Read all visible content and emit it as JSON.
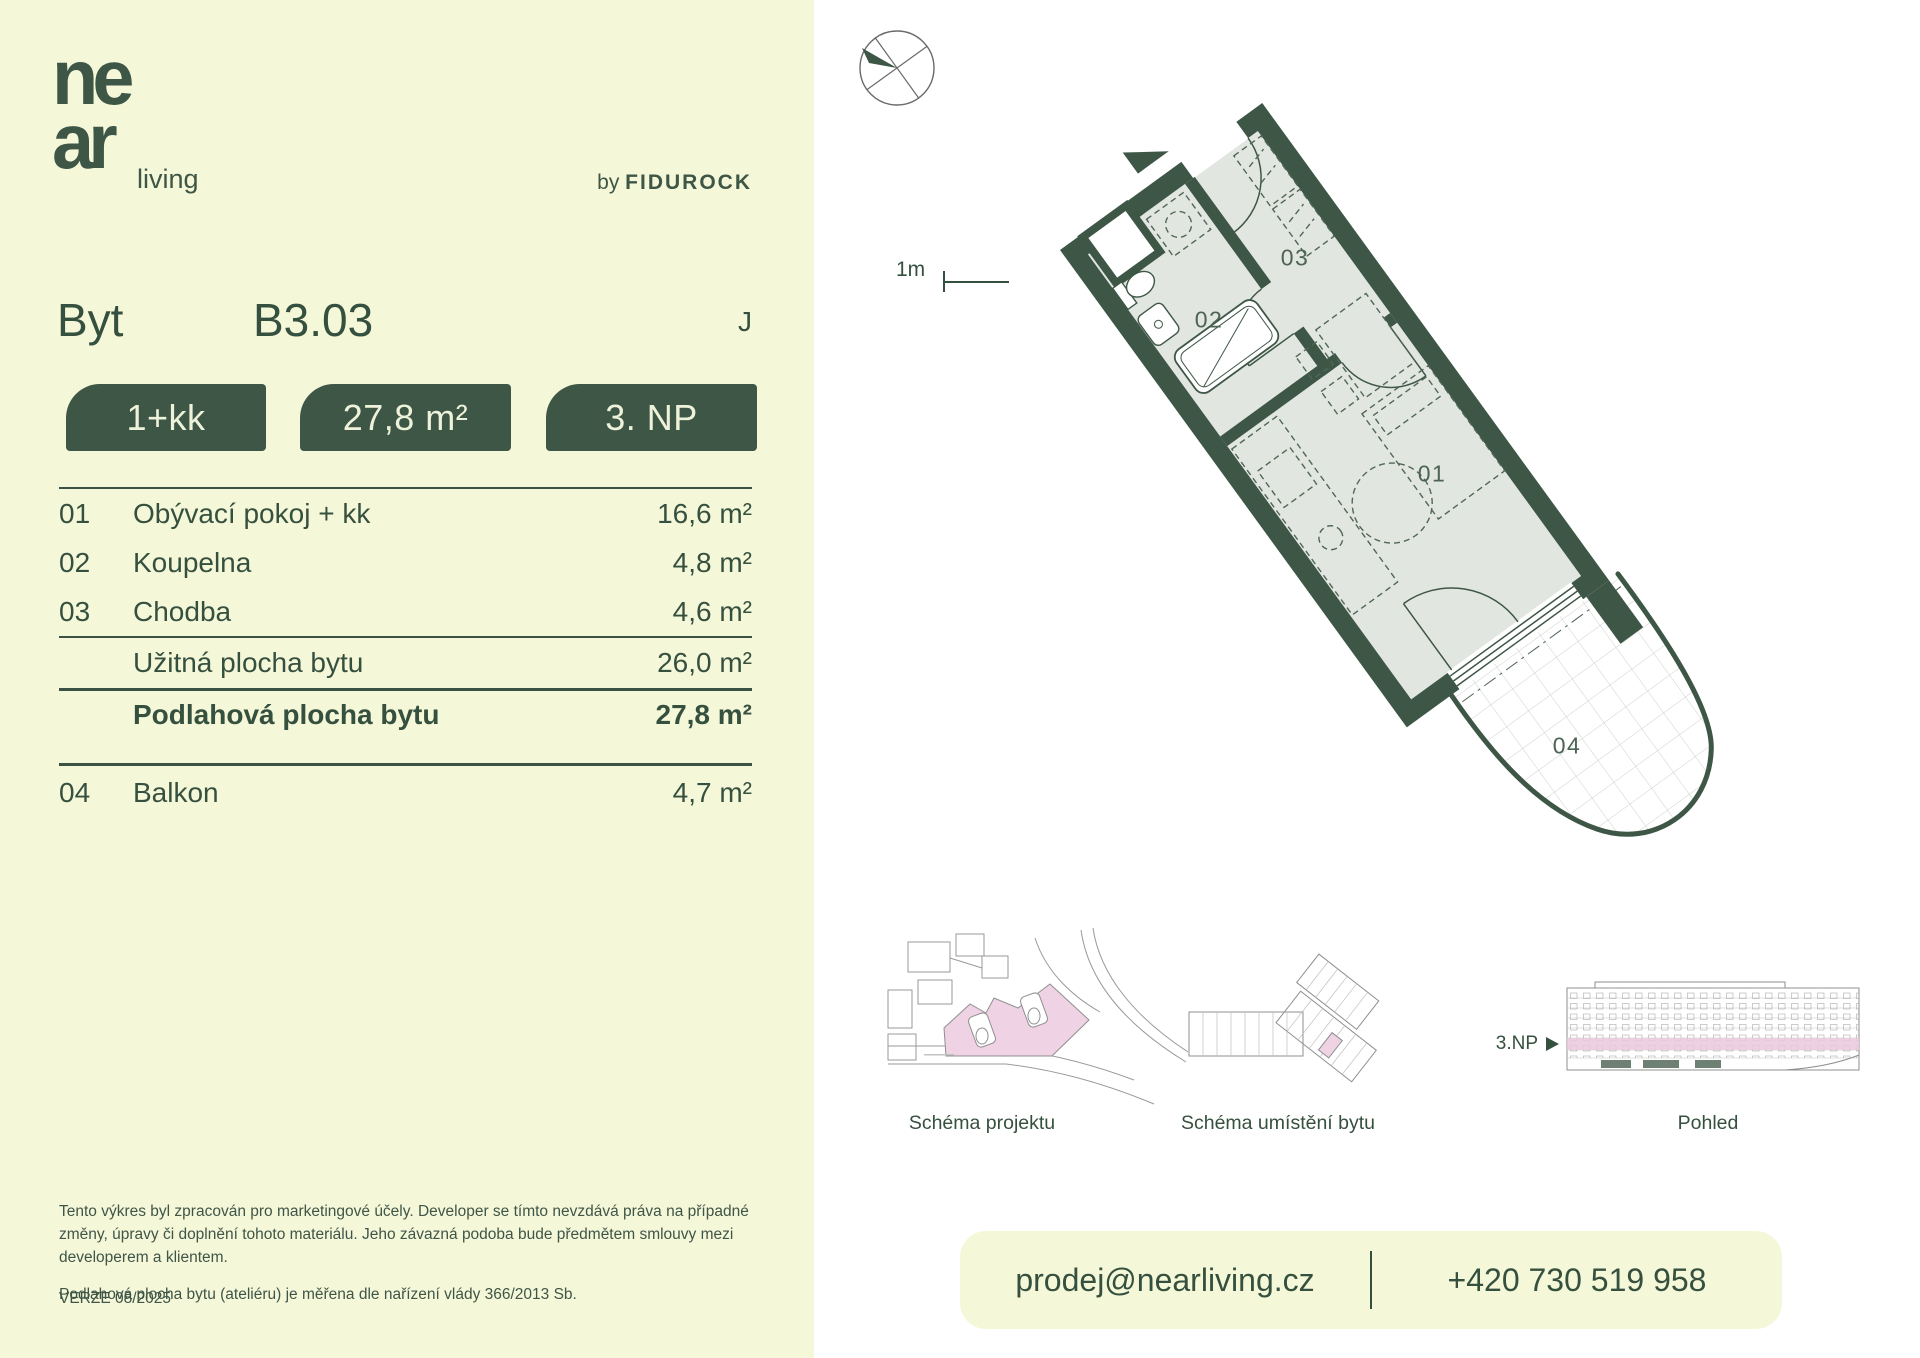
{
  "brand": {
    "logo_top": "ne",
    "logo_bottom": "ar",
    "logo_suffix": "living",
    "byline_prefix": "by",
    "byline_name": "FIDUROCK"
  },
  "header": {
    "type_label": "Byt",
    "unit_id": "B3.03",
    "orientation": "J"
  },
  "badges": {
    "layout": "1+kk",
    "area": "27,8 m²",
    "floor": "3. NP"
  },
  "room_table": {
    "rows": [
      {
        "number": "01",
        "name": "Obývací pokoj + kk",
        "area": "16,6 m²"
      },
      {
        "number": "02",
        "name": "Koupelna",
        "area": "4,8 m²"
      },
      {
        "number": "03",
        "name": "Chodba",
        "area": "4,6 m²"
      }
    ],
    "usable": {
      "name": "Užitná plocha bytu",
      "area": "26,0 m²"
    },
    "total": {
      "name": "Podlahová plocha bytu",
      "area": "27,8 m²"
    },
    "extra": {
      "number": "04",
      "name": "Balkon",
      "area": "4,7 m²"
    }
  },
  "plan": {
    "scale_label": "1m",
    "room_labels": [
      {
        "id": "01"
      },
      {
        "id": "02"
      },
      {
        "id": "03"
      },
      {
        "id": "04"
      }
    ]
  },
  "schematics": {
    "project_caption": "Schéma projektu",
    "unit_caption": "Schéma umístění bytu",
    "elevation_caption": "Pohled",
    "floor_marker": "3.NP"
  },
  "disclaimer": {
    "paragraph1": "Tento výkres byl zpracován pro marketingové účely. Developer se tímto nevzdává práva na případné změny, úpravy či doplnění tohoto materiálu. Jeho závazná podoba bude předmětem smlouvy mezi developerem a klientem.",
    "paragraph2": "Podlahová plocha bytu (ateliéru) je měřena dle nařízení vlády 366/2013 Sb.",
    "version": "VERZE 08/2025"
  },
  "contact": {
    "email": "prodej@nearliving.cz",
    "phone": "+420 730 519 958"
  },
  "colors": {
    "cream": "#f5f7d9",
    "green": "#3e5646",
    "ink": "#36503f",
    "floor": "#e2e6e1",
    "pink": "#efd2e4"
  }
}
